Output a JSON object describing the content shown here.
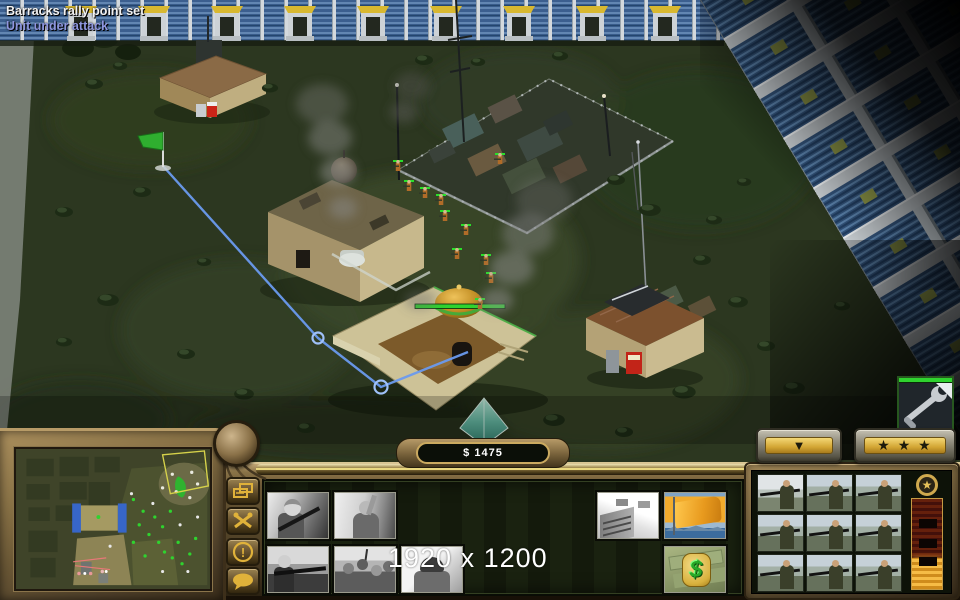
{
  "messages": {
    "line1": "Barracks rally point set",
    "line1_color": "#f2f2f2",
    "line2": "Unit under attack",
    "line2_color": "#8e96df"
  },
  "hud": {
    "money": "$ 1475",
    "resolution_overlay": "1920 x 1200"
  },
  "scene": {
    "rally_flag": "green-rally-flag",
    "rally_line_color": "#6a9aee",
    "selected_building": "gla-barracks",
    "health_bar_color": "#2fd32f"
  },
  "control_bar": {
    "side_buttons": [
      {
        "name": "structures-button"
      },
      {
        "name": "repair-tools-button"
      },
      {
        "name": "alert-button",
        "glyph": "!"
      },
      {
        "name": "chat-button"
      }
    ],
    "command_buttons": [
      {
        "name": "train-rebel"
      },
      {
        "name": "train-angry-mob-leader"
      },
      {
        "name": "set-rally-building"
      },
      {
        "name": "rally-flag"
      },
      {
        "name": "train-rpg-gunner"
      },
      {
        "name": "train-angry-mob"
      },
      {
        "name": "train-soldier"
      },
      {
        "name": "cash-bounty",
        "glyph": "$"
      }
    ],
    "top_buttons": {
      "collapse_glyph": "▼",
      "stars_glyph": "★ ★ ★"
    },
    "selection": {
      "count": 9,
      "unit": "rpg-soldier-portrait"
    },
    "rank_bar": {
      "fill_percent": 34,
      "emblem_glyph": "★"
    }
  },
  "colors": {
    "accent_gold": "#e0b23a",
    "health_green": "#2fd32f",
    "rally_blue": "#6a9aee"
  }
}
